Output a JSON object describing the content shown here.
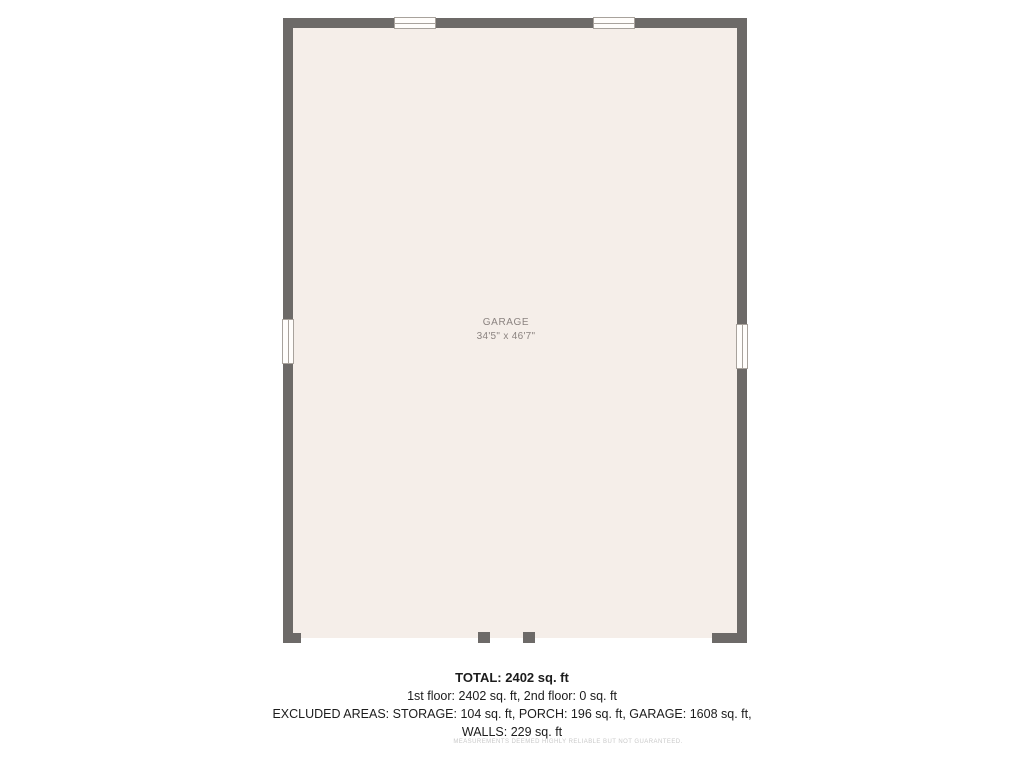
{
  "floorplan": {
    "room": {
      "name": "GARAGE",
      "dimensions": "34'5\" x 46'7\""
    },
    "colors": {
      "wall": "#6d6a68",
      "floor": "#f5eee9",
      "window_fill": "#fffdfb",
      "window_border": "#a8a29c",
      "room_label_text": "#8b8380"
    }
  },
  "summary": {
    "lines": [
      "TOTAL: 2402 sq. ft",
      "1st floor: 2402 sq. ft, 2nd floor: 0 sq. ft",
      "EXCLUDED AREAS: STORAGE: 104 sq. ft, PORCH: 196 sq. ft, GARAGE: 1608 sq. ft,",
      "WALLS: 229 sq. ft"
    ],
    "disclaimer": "MEASUREMENTS DEEMED HIGHLY RELIABLE BUT NOT GUARANTEED."
  }
}
